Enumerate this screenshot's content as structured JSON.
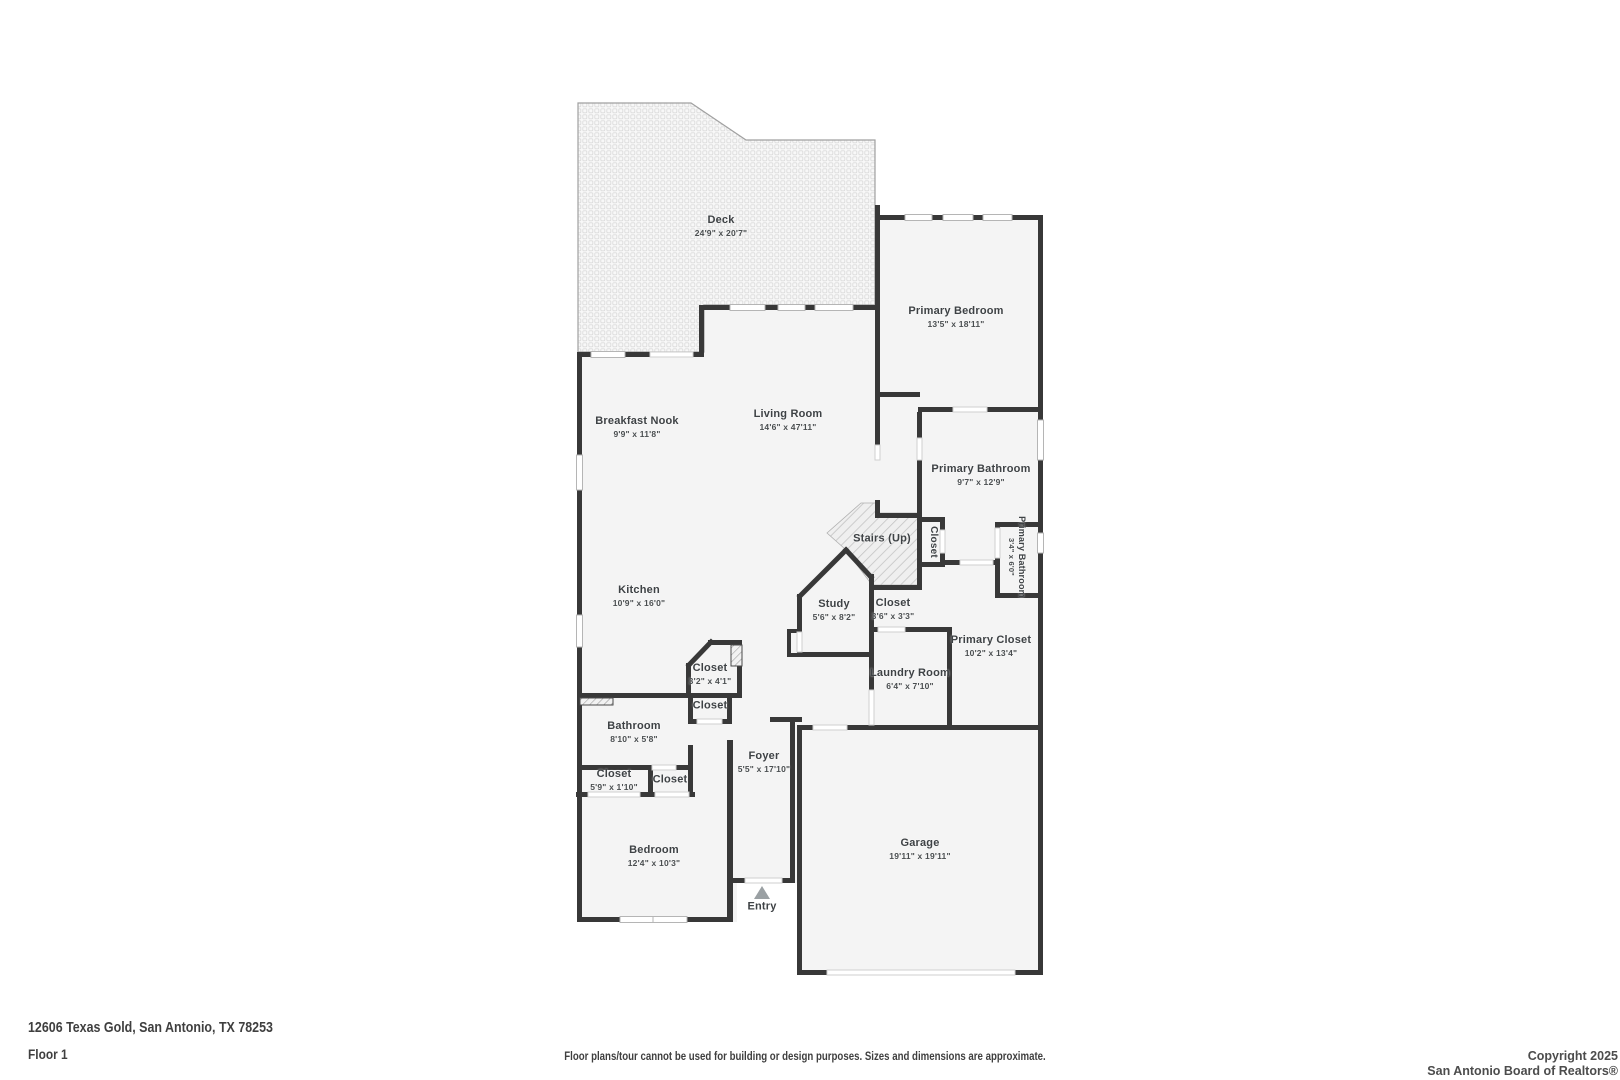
{
  "page": {
    "address": "12606 Texas Gold, San Antonio, TX 78253",
    "floor_label": "Floor 1",
    "disclaimer": "Floor plans/tour cannot be used for building or design purposes. Sizes and dimensions are approximate.",
    "copyright_line1": "Copyright 2025",
    "copyright_line2": "San Antonio Board of Realtors®"
  },
  "colors": {
    "wall": "#383838",
    "room_fill": "#f4f4f4",
    "label_text": "#3e4245",
    "entry_arrow": "#9aa0a3",
    "window_border": "#b5b5b5"
  },
  "rooms": [
    {
      "name": "Deck",
      "dims": "24'9\" x 20'7\"",
      "x": 721,
      "y": 226
    },
    {
      "name": "Primary Bedroom",
      "dims": "13'5\" x 18'11\"",
      "x": 956,
      "y": 317
    },
    {
      "name": "Living Room",
      "dims": "14'6\" x 47'11\"",
      "x": 788,
      "y": 420
    },
    {
      "name": "Breakfast Nook",
      "dims": "9'9\" x 11'8\"",
      "x": 637,
      "y": 427
    },
    {
      "name": "Primary Bathroom",
      "dims": "9'7\" x 12'9\"",
      "x": 981,
      "y": 475
    },
    {
      "name": "Stairs (Up)",
      "x": 882,
      "y": 539
    },
    {
      "name": "Closet",
      "x": 933,
      "y": 542
    },
    {
      "name": "Primary Bathroom",
      "dims": "3'4\" x 6'0\"",
      "x": 1017,
      "y": 557
    },
    {
      "name": "Kitchen",
      "dims": "10'9\" x 16'0\"",
      "x": 639,
      "y": 596
    },
    {
      "name": "Study",
      "dims": "5'6\" x 8'2\"",
      "x": 834,
      "y": 610
    },
    {
      "name": "Closet",
      "dims": "3'6\" x 3'3\"",
      "x": 893,
      "y": 609
    },
    {
      "name": "Primary Closet",
      "dims": "10'2\" x 13'4\"",
      "x": 991,
      "y": 646
    },
    {
      "name": "Laundry Room",
      "dims": "6'4\" x 7'10\"",
      "x": 910,
      "y": 679
    },
    {
      "name": "Closet",
      "dims": "3'2\" x 4'1\"",
      "x": 710,
      "y": 674
    },
    {
      "name": "Closet",
      "x": 710,
      "y": 706
    },
    {
      "name": "Bathroom",
      "dims": "8'10\" x 5'8\"",
      "x": 634,
      "y": 732
    },
    {
      "name": "Closet",
      "dims": "5'9\" x 1'10\"",
      "x": 614,
      "y": 780
    },
    {
      "name": "Closet",
      "x": 670,
      "y": 780
    },
    {
      "name": "Foyer",
      "dims": "5'5\" x 17'10\"",
      "x": 764,
      "y": 762
    },
    {
      "name": "Bedroom",
      "dims": "12'4\" x 10'3\"",
      "x": 654,
      "y": 856
    },
    {
      "name": "Garage",
      "dims": "19'11\" x 19'11\"",
      "x": 920,
      "y": 849
    },
    {
      "name": "Entry",
      "x": 762,
      "y": 907
    }
  ]
}
